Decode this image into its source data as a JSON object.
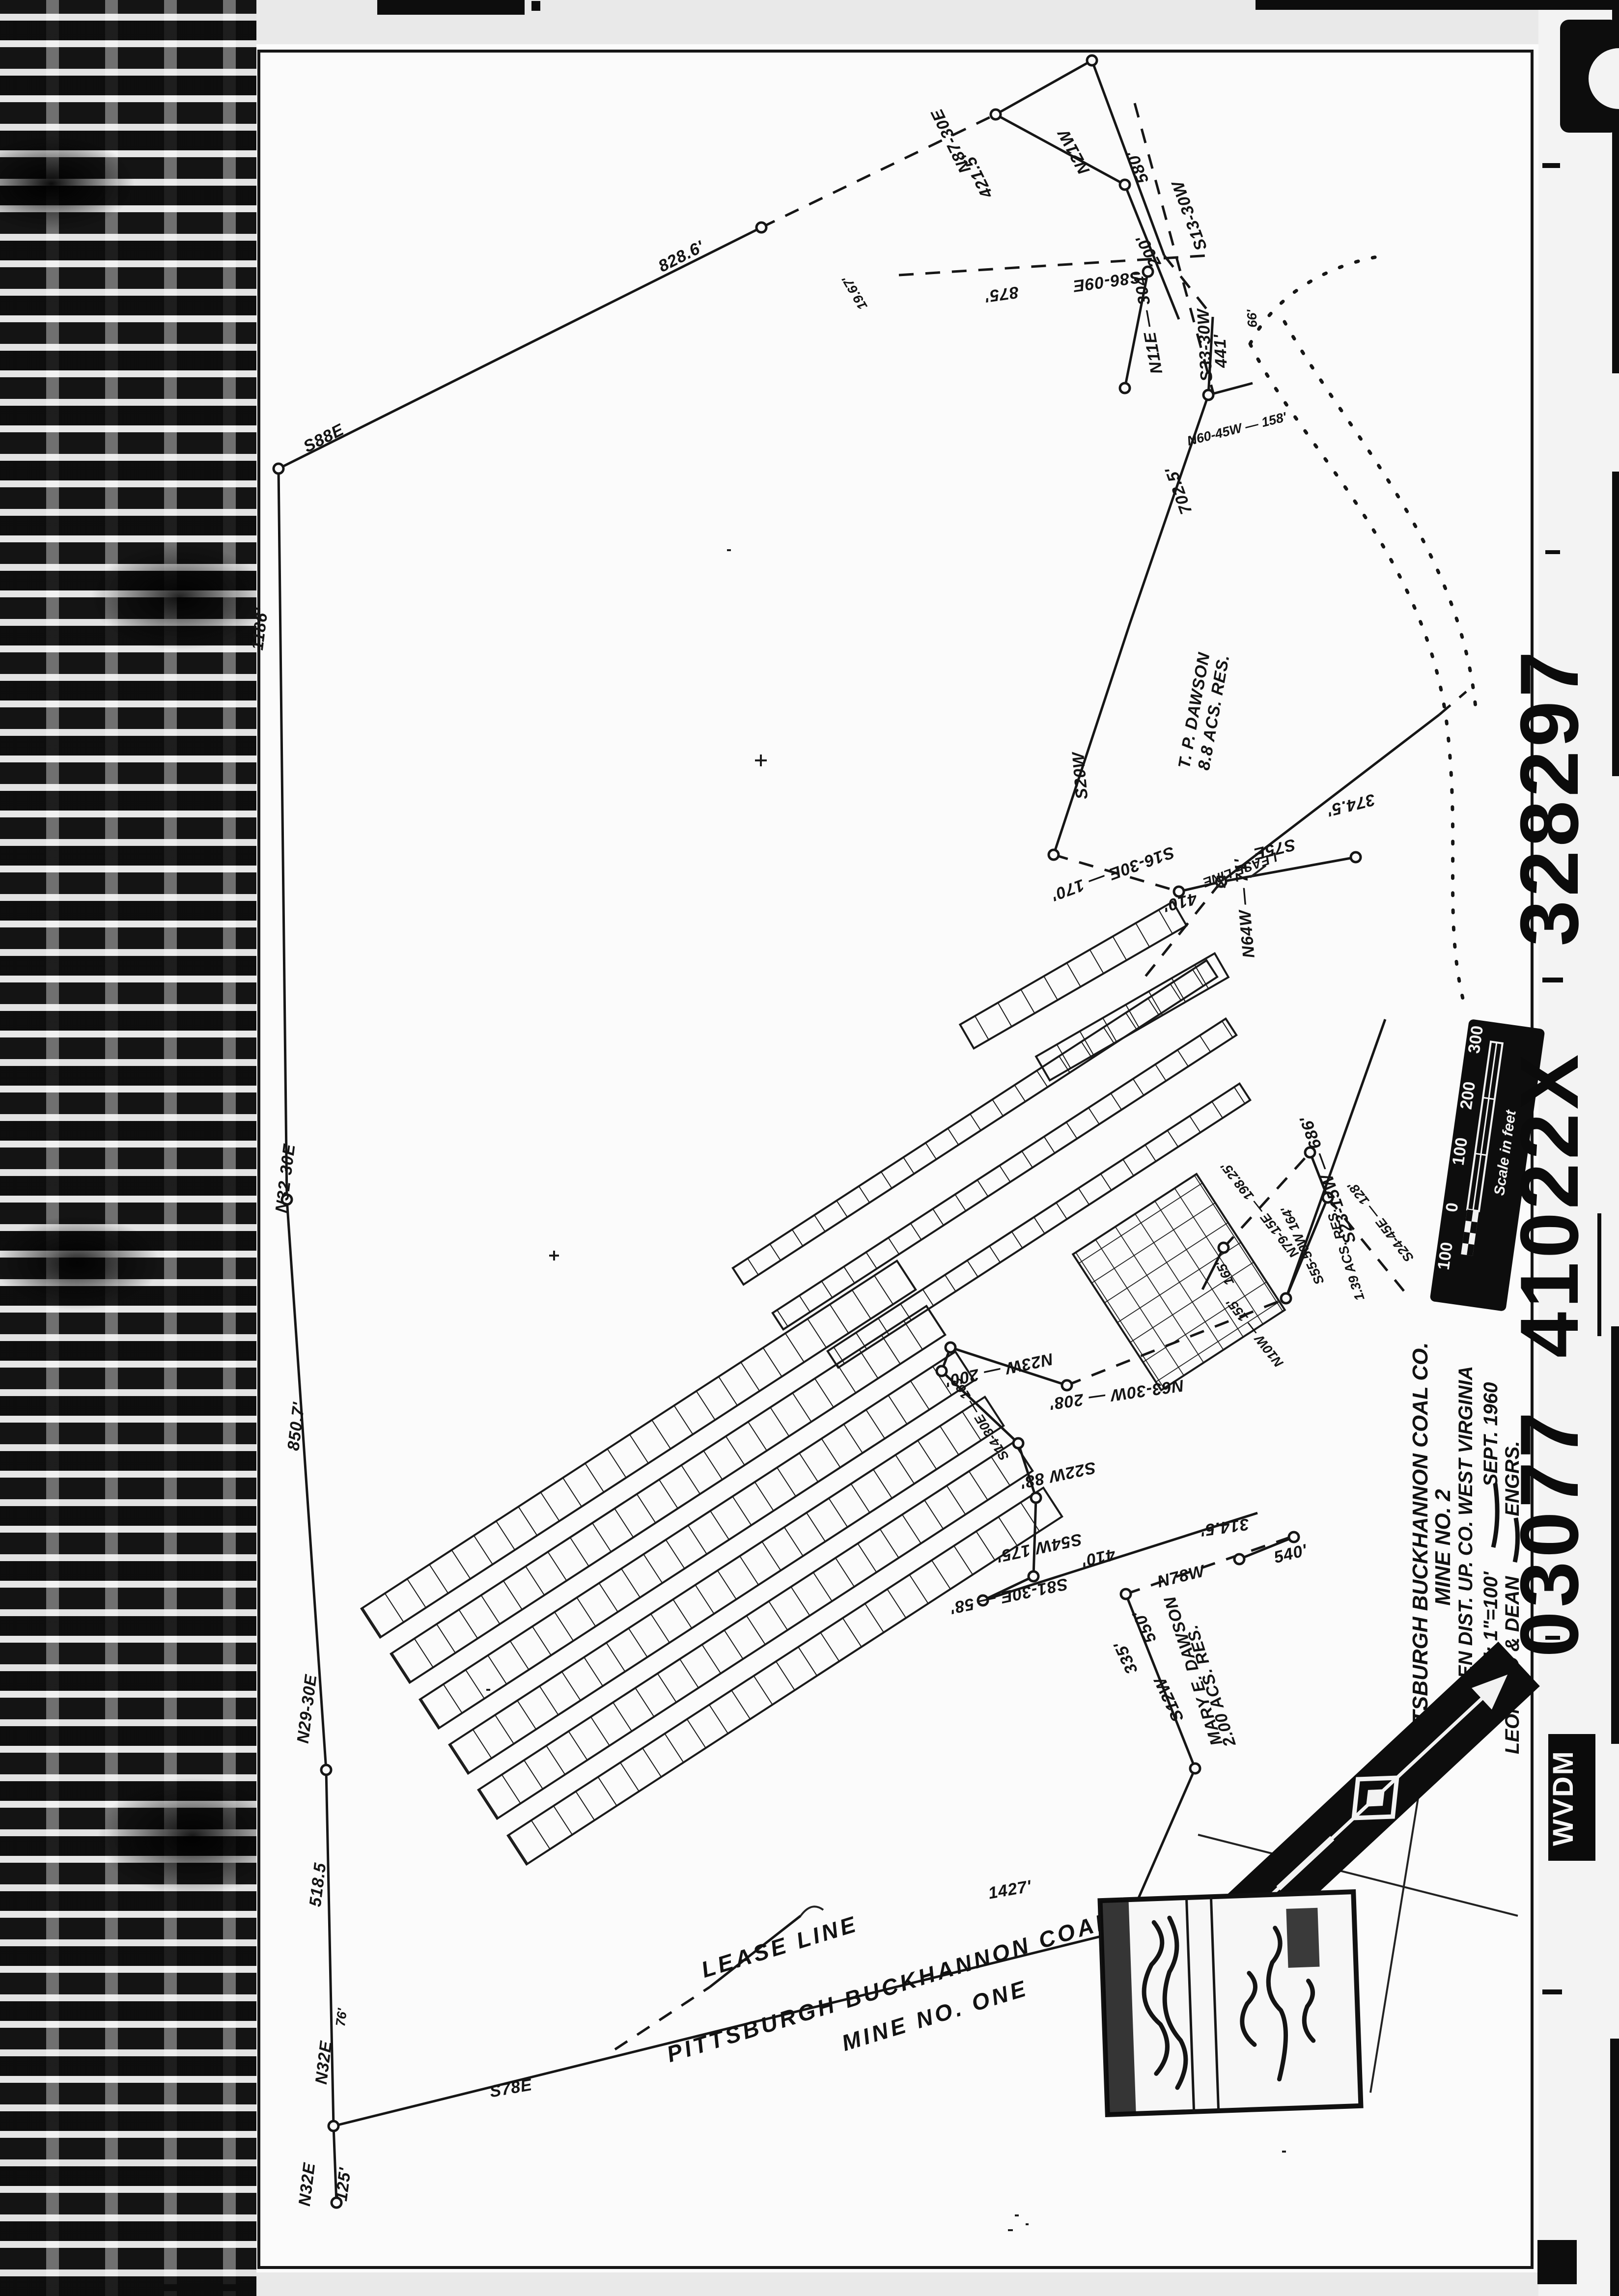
{
  "film_strip": {
    "agency_code": "WVDM",
    "frame_numbers": [
      "03077",
      "410",
      "22X",
      "328297"
    ]
  },
  "title_block": {
    "company": "PITTSBURGH BUCKHANNON COAL CO.",
    "mine": "MINE NO. 2",
    "district": "WARREN DIST. UP. CO. WEST VIRGINIA",
    "scale": "SCALE: 1\"=100'",
    "date": "SEPT. 1960",
    "engineers": "LEONARD & DEAN",
    "engineers_suffix": "ENGRS."
  },
  "scale_bar": {
    "ticks": [
      "300",
      "200",
      "100",
      "0",
      "100"
    ],
    "caption": "Scale in feet"
  },
  "lease_annotation": {
    "lease_line": "LEASE LINE",
    "company": "PITTSBURGH BUCKHANNON COAL CO.",
    "mine": "MINE NO. ONE",
    "lease_line_small": "LEASE LINE"
  },
  "adjoining_tracts": {
    "tract1_owner": "T. P. DAWSON",
    "tract1_area": "8.8 ACS. RES.",
    "tract2_owner": "MARY E. DAWSON",
    "tract2_area": "2.00 ACS. RES.",
    "tract3_area": "1.39 ACS. RES."
  },
  "survey_calls": {
    "c01": "1186'",
    "c02": "N32-30E",
    "c03": "850.7'",
    "c04": "N29-30E",
    "c05": "518.5",
    "c06": "76'",
    "c07": "N32E",
    "c08": "N32E",
    "c09": "125'",
    "c10": "S78E",
    "c11": "1427'",
    "c12": "S88E",
    "c13": "828.6'",
    "c14": "N87-30E",
    "c15": "421.5'",
    "c16": "580'",
    "c17": "N21W",
    "c18": "200'",
    "c19": "875'",
    "c20": "S86-09E",
    "c21": "N11E — 304'",
    "c22": "S13-30W",
    "c23": "S33-30W",
    "c24": "441'",
    "c25": "66'",
    "c26": "N60-45W — 158'",
    "c27": "702.5'",
    "c28": "S20W",
    "c29": "S16-30E — 170'",
    "c30": "410'",
    "c31": "S75E",
    "c32": "374.5'",
    "c33": "N64W — 71'",
    "c34": "S23-15W — 686'",
    "c35": "N79-15E — 198.25'",
    "c36": "S55-50W 164'",
    "c37": "S24-45E — 128'",
    "c38": "165'",
    "c39": "N10W — 155'",
    "c40": "N23W — 200'",
    "c41": "N63-30W — 208'",
    "c42": "S14-30E — 163'",
    "c43": "S22W 88'",
    "c44": "S54W 175'",
    "c45": "S81-30E — 58'",
    "c46": "410'",
    "c47": "314.5'",
    "c48": "N78W",
    "c49": "540'",
    "c50": "550'",
    "c51": "335'",
    "c52": "S12W",
    "c53": "19.67'"
  }
}
